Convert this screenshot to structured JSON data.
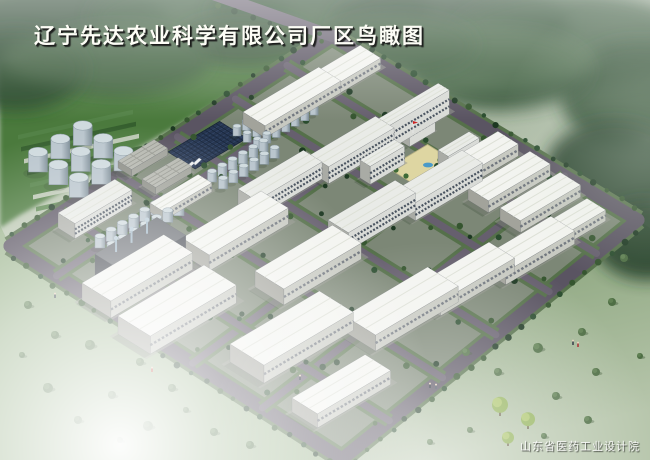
{
  "title": {
    "text": "辽宁先达农业科学有限公司厂区鸟瞰图"
  },
  "watermark": {
    "text": "山东省医药工业设计院"
  },
  "palette": {
    "bg_top": "#9aaa96",
    "bg_mid": "#b9c6b0",
    "bg_bot": "#d6decd",
    "field": "#4b7a3e",
    "grass_sw": "#9fb791",
    "grass_se": "#7d9a6e",
    "tree_dark": "#1d3822",
    "tree_mid": "#2a4c2e",
    "tree_light": "#35552f",
    "site_ground": "#868b80",
    "verge": "#55704a",
    "asphalt": "#665f6e",
    "asphalt_dark": "#5a5462",
    "wh_roof": "#f3f4f0",
    "wh_facade": "#c7c9c1",
    "wh_end": "#a2a39b",
    "wh_band": "#70767e",
    "ml_roof": "#e9ebe7",
    "ml_facade": "#d9dbd7",
    "ml_end": "#a9aba5",
    "ml_band": "#49535f",
    "low_roof": "#b5b7af",
    "low_facade": "#9fa199",
    "low_end": "#8a8c84",
    "chem_roof": "#686c72",
    "chem_facade": "#474b53",
    "chem_end": "#3b3f47",
    "chem_pipe": "#6d94b4",
    "solar": "#26354f",
    "solar_grid": "#18263c",
    "solar_grid2": "#33486b",
    "tank_top": "#cfdade",
    "tank_hi": "#b9c5cd",
    "tank_lo": "#7e8e98",
    "courtyard": "#ded6a2",
    "pool": "#4a9ac8",
    "flag": "#cc2222",
    "apron": "#96988f",
    "shadow": "#20301e"
  },
  "scene": {
    "corners": {
      "w": [
        10,
        246
      ],
      "n": [
        332,
        36
      ],
      "e": [
        638,
        220
      ],
      "s": [
        342,
        459
      ]
    },
    "axes": {
      "u": [
        0.86,
        -0.51
      ],
      "v": [
        0.85,
        0.53
      ]
    },
    "ext_road": [
      [
        213,
        -6
      ],
      [
        332,
        36
      ]
    ],
    "roads_b": [
      0.14,
      0.34,
      0.55,
      0.76
    ],
    "roads_a": [
      0.16,
      0.34,
      0.52,
      0.7,
      0.86
    ],
    "buildings": [
      {
        "t": "ml",
        "x": 58,
        "y": 228,
        "l": 66,
        "w": 20,
        "h": 15
      },
      {
        "t": "wh",
        "x": 150,
        "y": 212,
        "l": 56,
        "w": 16,
        "h": 9
      },
      {
        "t": "low",
        "x": 118,
        "y": 168,
        "l": 42,
        "w": 16,
        "h": 7
      },
      {
        "t": "low",
        "x": 142,
        "y": 186,
        "l": 42,
        "w": 16,
        "h": 7
      },
      {
        "t": "low",
        "x": 95,
        "y": 205,
        "l": 26,
        "w": 12,
        "h": 8
      },
      {
        "t": "wh",
        "x": 243,
        "y": 124,
        "l": 88,
        "w": 26,
        "h": 12
      },
      {
        "t": "wh",
        "x": 300,
        "y": 92,
        "l": 70,
        "w": 24,
        "h": 11
      },
      {
        "t": "ml",
        "x": 238,
        "y": 206,
        "l": 76,
        "w": 22,
        "h": 17
      },
      {
        "t": "ml",
        "x": 310,
        "y": 172,
        "l": 76,
        "w": 22,
        "h": 17
      },
      {
        "t": "chem",
        "x": 95,
        "y": 278,
        "l": 72,
        "w": 34,
        "h": 24
      },
      {
        "t": "wh",
        "x": 82,
        "y": 300,
        "l": 95,
        "w": 34,
        "h": 17
      },
      {
        "t": "wh",
        "x": 182,
        "y": 254,
        "l": 92,
        "w": 32,
        "h": 16
      },
      {
        "t": "wh",
        "x": 255,
        "y": 287,
        "l": 90,
        "w": 34,
        "h": 16
      },
      {
        "t": "ml",
        "x": 328,
        "y": 238,
        "l": 78,
        "w": 24,
        "h": 18
      },
      {
        "t": "ml",
        "x": 395,
        "y": 208,
        "l": 78,
        "w": 24,
        "h": 18
      },
      {
        "t": "wh",
        "x": 436,
        "y": 180,
        "l": 72,
        "w": 24,
        "h": 12
      },
      {
        "t": "wh",
        "x": 468,
        "y": 200,
        "l": 72,
        "w": 24,
        "h": 12
      },
      {
        "t": "wh",
        "x": 500,
        "y": 220,
        "l": 70,
        "w": 24,
        "h": 12
      },
      {
        "t": "wh",
        "x": 532,
        "y": 242,
        "l": 64,
        "w": 22,
        "h": 11
      },
      {
        "t": "wh",
        "x": 415,
        "y": 300,
        "l": 86,
        "w": 30,
        "h": 14
      },
      {
        "t": "wh",
        "x": 482,
        "y": 270,
        "l": 80,
        "w": 28,
        "h": 13
      },
      {
        "t": "wh",
        "x": 118,
        "y": 334,
        "l": 100,
        "w": 38,
        "h": 18
      },
      {
        "t": "wh",
        "x": 230,
        "y": 362,
        "l": 104,
        "w": 40,
        "h": 18
      },
      {
        "t": "wh",
        "x": 345,
        "y": 332,
        "l": 96,
        "w": 36,
        "h": 16
      },
      {
        "t": "wh",
        "x": 292,
        "y": 412,
        "l": 85,
        "w": 30,
        "h": 14
      },
      {
        "t": "ml",
        "x": 400,
        "y": 141,
        "l": 30,
        "w": 11,
        "h": 32
      },
      {
        "t": "ml",
        "x": 366,
        "y": 150,
        "l": 84,
        "w": 13,
        "h": 24
      },
      {
        "t": "ml",
        "x": 360,
        "y": 178,
        "l": 40,
        "w": 12,
        "h": 18
      },
      {
        "t": "ml",
        "x": 438,
        "y": 168,
        "l": 36,
        "w": 12,
        "h": 18
      }
    ],
    "tank_clusters": [
      {
        "x": 38,
        "y": 172,
        "rows": 3,
        "cols": 3,
        "dx": 26,
        "dy": 24,
        "d": 19,
        "h": 20
      },
      {
        "x": 100,
        "y": 248,
        "rows": 2,
        "cols": 7,
        "dx": 13,
        "dy": 14,
        "d": 10,
        "h": 12
      },
      {
        "x": 212,
        "y": 182,
        "rows": 2,
        "cols": 6,
        "dx": 12,
        "dy": 13,
        "d": 9,
        "h": 11
      },
      {
        "x": 237,
        "y": 136,
        "rows": 3,
        "cols": 7,
        "dx": 11,
        "dy": 12,
        "d": 8,
        "h": 10
      }
    ],
    "solar": {
      "x": 168,
      "y": 152,
      "l": 60,
      "w": 32
    },
    "courtyard": {
      "x": 388,
      "y": 168,
      "l": 46,
      "w": 26
    },
    "pool": [
      428,
      165
    ],
    "flag": [
      413,
      121
    ],
    "court_trees": [
      [
        396,
        170
      ],
      [
        406,
        176
      ],
      [
        420,
        182
      ],
      [
        434,
        172
      ],
      [
        440,
        160
      ]
    ],
    "cars": {
      "start": [
        172,
        174
      ],
      "step": [
        7,
        -3.5
      ],
      "n": 4
    },
    "figures": [
      [
        152,
        372,
        "#c03028"
      ],
      [
        430,
        388,
        "#26303a"
      ],
      [
        436,
        389,
        "#46525e"
      ],
      [
        55,
        298,
        "#333d48"
      ],
      [
        573,
        345,
        "#26303a"
      ],
      [
        578,
        347,
        "#a32626"
      ],
      [
        300,
        380,
        "#26303a"
      ]
    ],
    "bushes": [
      [
        28,
        305,
        4
      ],
      [
        55,
        335,
        4
      ],
      [
        90,
        345,
        5
      ],
      [
        140,
        362,
        4
      ],
      [
        48,
        388,
        5
      ],
      [
        112,
        395,
        4
      ],
      [
        172,
        388,
        4
      ],
      [
        78,
        420,
        4
      ],
      [
        148,
        426,
        5
      ],
      [
        214,
        432,
        4
      ],
      [
        250,
        445,
        4
      ],
      [
        22,
        355,
        3
      ],
      [
        186,
        410,
        3
      ],
      [
        120,
        440,
        3
      ],
      [
        466,
        352,
        4
      ],
      [
        498,
        372,
        4
      ],
      [
        538,
        348,
        5
      ],
      [
        582,
        332,
        4
      ],
      [
        612,
        302,
        4
      ],
      [
        596,
        372,
        4
      ],
      [
        556,
        396,
        4
      ],
      [
        624,
        258,
        4
      ],
      [
        640,
        356,
        3
      ],
      [
        588,
        420,
        4
      ],
      [
        544,
        436,
        3
      ],
      [
        470,
        430,
        3
      ],
      [
        430,
        442,
        3
      ]
    ],
    "bright_trees": [
      [
        500,
        408,
        8
      ],
      [
        528,
        422,
        7
      ],
      [
        508,
        440,
        6
      ]
    ],
    "greenhouse": {
      "origin": [
        18,
        135
      ],
      "step_y": 12,
      "n": 7,
      "dir": [
        1,
        -0.22
      ],
      "len": 115,
      "wid": 4.5
    },
    "tree_band": [
      [
        60,
        25,
        110,
        45
      ],
      [
        190,
        18,
        100,
        38
      ],
      [
        320,
        12,
        110,
        36
      ],
      [
        450,
        25,
        120,
        42
      ],
      [
        570,
        40,
        120,
        48
      ],
      [
        640,
        95,
        80,
        55
      ],
      [
        615,
        170,
        70,
        50
      ],
      [
        500,
        70,
        90,
        40
      ],
      [
        395,
        45,
        80,
        30
      ],
      [
        245,
        40,
        70,
        26
      ],
      [
        120,
        60,
        90,
        34
      ],
      [
        15,
        70,
        70,
        40
      ],
      [
        648,
        240,
        55,
        40
      ]
    ],
    "hedges": [
      [
        [
          10,
          246
        ],
        [
          332,
          36
        ]
      ],
      [
        [
          10,
          246
        ],
        [
          150,
          335
        ]
      ]
    ]
  }
}
